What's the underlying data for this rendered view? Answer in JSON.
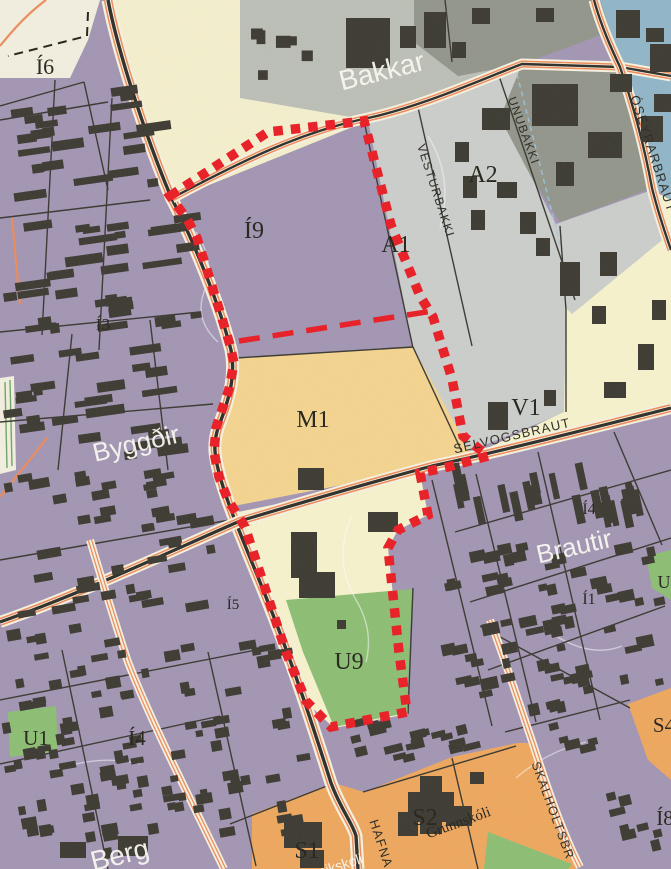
{
  "map": {
    "canvas": {
      "w": 671,
      "h": 869
    },
    "palette": {
      "base_purple": "#a295b3",
      "building": "#3a382f",
      "cream": "#f5f0cd",
      "cream_light": "#f3efe0",
      "gray_bakkar": "#bcbfb6",
      "olive": "#92958a",
      "gray_a": "#cbcecb",
      "blue": "#90b6c8",
      "yellow_pale": "#f7f3cd",
      "tan_m1": "#f5d48e",
      "green": "#8cbe72",
      "orange_s": "#efa75c",
      "road_orange": "#ef8a58",
      "road_cream": "#f7f2e0",
      "road_black": "#2d2c26",
      "boundary_red": "#ea1b22",
      "contour_white": "#ffffff",
      "utility_blue": "#9cc8e2",
      "green_line": "#5e9c57"
    },
    "zones": [
      {
        "name": "cream-top-left",
        "fill": "cream_light",
        "points": "0,0 100,0 88,40 70,78 0,78"
      },
      {
        "name": "cream-road-strip",
        "fill": "cream",
        "points": "108,0 240,0 240,96 370,120 172,200 120,40"
      },
      {
        "name": "bakkar-gray",
        "fill": "gray_bakkar",
        "points": "240,0 414,0 414,42 458,76 522,64 368,120 240,98"
      },
      {
        "name": "olive-north",
        "fill": "olive",
        "points": "414,0 598,0 620,28 522,64 458,76 414,42"
      },
      {
        "name": "olive-east",
        "fill": "olive",
        "points": "522,64 620,68 652,188 560,222 496,120"
      },
      {
        "name": "gray-a1-a2",
        "fill": "gray_a",
        "points": "368,120 522,64 500,118 556,224 566,310 566,412 460,455 413,348"
      },
      {
        "name": "gray-a-east",
        "fill": "gray_a",
        "points": "556,224 652,190 662,240 572,314 566,310"
      },
      {
        "name": "blue-northeast",
        "fill": "blue",
        "points": "600,0 671,0 671,200 652,186 622,66"
      },
      {
        "name": "yellow-v1",
        "fill": "yellow_pale",
        "points": "652,190 671,200 671,410 462,460 564,412 566,308 572,314 662,240"
      },
      {
        "name": "tan-m1",
        "fill": "tan_m1",
        "points": "236,358 413,347 470,452 460,462 234,506 216,472 216,424 230,388"
      },
      {
        "name": "yellow-below-road",
        "fill": "yellow_pale",
        "points": "238,512 452,468 488,456 448,467 420,473 428,515 398,530 388,548 399,652 408,714 334,728 306,702 286,652 263,582 245,527"
      },
      {
        "name": "green-u9",
        "fill": "green",
        "points": "286,600 412,589 407,713 334,727 303,652"
      },
      {
        "name": "green-u1",
        "fill": "green",
        "points": "8,712 56,706 58,752 10,757"
      },
      {
        "name": "green-east-patch",
        "fill": "green",
        "points": "646,556 671,550 671,600 652,588"
      },
      {
        "name": "orange-s1-s2",
        "fill": "orange_s",
        "points": "252,814 334,783 364,792 452,757 517,743 531,743 560,835 576,860 576,869 252,869"
      },
      {
        "name": "orange-s4",
        "fill": "orange_s",
        "points": "628,704 671,688 671,780 648,760"
      },
      {
        "name": "green-southeast",
        "fill": "green",
        "points": "488,832 572,864 568,869 484,869"
      },
      {
        "name": "cream-west-strip",
        "fill": "cream_light",
        "points": "0,378 14,376 16,470 0,474"
      }
    ],
    "contours": [
      {
        "d": "M196,232 q20,30 8,60 q-10,28 14,50",
        "s": "contour_white",
        "o": 0.5
      },
      {
        "d": "M352,516 q-20,42 4,84 q18,30 10,62",
        "s": "contour_white",
        "o": 0.5
      },
      {
        "d": "M428,136 q26,42 12,92",
        "s": "contour_white",
        "o": 0.45
      },
      {
        "d": "M517,74 L562,252",
        "s": "utility_blue",
        "o": 0.85,
        "dash": "5 4"
      },
      {
        "d": "M556,636 q36,22 66,10",
        "s": "contour_white",
        "o": 0.5
      },
      {
        "d": "M56,770 q44,-16 84,-6",
        "s": "contour_white",
        "o": 0.5
      },
      {
        "d": "M586,742 q-40,10 -70,36",
        "s": "contour_white",
        "o": 0.5
      },
      {
        "d": "M5,382 L7,468",
        "s": "green_line",
        "o": 0.9
      },
      {
        "d": "M10,380 L12,466",
        "s": "green_line",
        "o": 0.9
      }
    ],
    "streets": [
      [
        55,
        80,
        42,
        335
      ],
      [
        112,
        98,
        99,
        350
      ],
      [
        0,
        120,
        108,
        102
      ],
      [
        0,
        218,
        150,
        200
      ],
      [
        0,
        332,
        200,
        312
      ],
      [
        0,
        422,
        213,
        404
      ],
      [
        72,
        334,
        58,
        470
      ],
      [
        150,
        320,
        168,
        470
      ],
      [
        84,
        82,
        108,
        190
      ],
      [
        0,
        106,
        84,
        82
      ],
      [
        0,
        700,
        256,
        650
      ],
      [
        62,
        650,
        108,
        869
      ],
      [
        208,
        652,
        256,
        866
      ],
      [
        0,
        764,
        220,
        716
      ],
      [
        0,
        560,
        230,
        520
      ],
      [
        455,
        532,
        671,
        470
      ],
      [
        470,
        602,
        671,
        538
      ],
      [
        488,
        670,
        665,
        606
      ],
      [
        432,
        480,
        492,
        726
      ],
      [
        538,
        452,
        600,
        720
      ],
      [
        614,
        432,
        662,
        545
      ],
      [
        476,
        474,
        536,
        722
      ],
      [
        417,
        103,
        472,
        346
      ],
      [
        497,
        70,
        575,
        300
      ],
      [
        445,
        0,
        452,
        62
      ],
      [
        480,
        626,
        630,
        708
      ],
      [
        363,
        792,
        516,
        746
      ],
      [
        230,
        824,
        332,
        784
      ],
      [
        452,
        758,
        478,
        869
      ],
      [
        236,
        358,
        413,
        347
      ],
      [
        364,
        121,
        413,
        348
      ],
      [
        413,
        347,
        462,
        452
      ],
      [
        560,
        226,
        566,
        310
      ],
      [
        566,
        310,
        566,
        412
      ],
      [
        413,
        588,
        408,
        714
      ],
      [
        505,
        732,
        630,
        700
      ]
    ],
    "roads": [
      {
        "name": "main-road",
        "style": "major",
        "d": "M108,0 C120,62 152,152 171,197 C186,226 216,292 231,350 C236,376 229,400 218,428 C213,444 214,456 221,480 C233,522 262,582 287,652 C301,690 318,742 331,783 C341,810 352,822 356,836 L358,869"
      },
      {
        "name": "top-road",
        "style": "secondary",
        "d": "M172,198 C240,162 300,132 368,118 C420,107 480,80 522,64 L620,67 L671,76"
      },
      {
        "name": "oseyrarbraut-road",
        "style": "secondary",
        "d": "M594,0 C601,26 612,50 620,67 C635,110 645,150 652,188 C658,212 664,230 671,250"
      },
      {
        "name": "selvogsbraut-road",
        "style": "major2",
        "d": "M0,622 C80,594 160,556 240,521 C310,500 372,482 432,466 C502,451 580,431 671,408"
      },
      {
        "name": "skalholtsbraut-road",
        "style": "minor",
        "d": "M490,620 C505,660 520,706 533,744 C546,784 562,832 580,867"
      },
      {
        "name": "west-orange-road",
        "style": "minor",
        "d": "M90,540 C102,580 114,620 128,662 C152,724 192,802 224,869"
      },
      {
        "name": "top-left-arc-road",
        "style": "thin",
        "d": "M0,46 Q24,16 46,0"
      },
      {
        "name": "left-orange-stub",
        "style": "thin",
        "d": "M12,218 L20,304"
      },
      {
        "name": "sw-orange-stub",
        "style": "thin",
        "d": "M47,438 L0,497"
      }
    ],
    "buildings": [
      [
        346,
        18,
        44,
        50
      ],
      [
        400,
        26,
        16,
        22
      ],
      [
        424,
        12,
        22,
        36
      ],
      [
        452,
        42,
        14,
        16
      ],
      [
        472,
        8,
        18,
        16
      ],
      [
        536,
        8,
        18,
        14
      ],
      [
        532,
        84,
        46,
        42
      ],
      [
        588,
        132,
        34,
        26
      ],
      [
        610,
        74,
        22,
        18
      ],
      [
        556,
        162,
        18,
        24
      ],
      [
        482,
        108,
        28,
        22
      ],
      [
        455,
        142,
        14,
        20
      ],
      [
        463,
        176,
        14,
        22
      ],
      [
        471,
        210,
        14,
        20
      ],
      [
        497,
        182,
        20,
        16
      ],
      [
        520,
        212,
        16,
        22
      ],
      [
        536,
        238,
        14,
        18
      ],
      [
        616,
        10,
        24,
        28
      ],
      [
        646,
        28,
        18,
        14
      ],
      [
        650,
        44,
        21,
        28
      ],
      [
        654,
        94,
        17,
        18
      ],
      [
        641,
        116,
        22,
        26
      ],
      [
        560,
        262,
        20,
        34
      ],
      [
        600,
        252,
        17,
        24
      ],
      [
        592,
        306,
        14,
        18
      ],
      [
        638,
        344,
        16,
        26
      ],
      [
        604,
        382,
        22,
        16
      ],
      [
        488,
        402,
        20,
        28
      ],
      [
        544,
        390,
        12,
        16
      ],
      [
        652,
        300,
        14,
        20
      ],
      [
        298,
        468,
        26,
        22
      ],
      [
        291,
        532,
        26,
        46
      ],
      [
        299,
        572,
        36,
        26
      ],
      [
        368,
        512,
        30,
        20
      ],
      [
        337,
        620,
        9,
        9
      ],
      [
        408,
        792,
        46,
        30
      ],
      [
        420,
        776,
        22,
        58
      ],
      [
        398,
        812,
        20,
        24
      ],
      [
        446,
        806,
        26,
        20
      ],
      [
        470,
        772,
        14,
        12
      ],
      [
        284,
        822,
        38,
        26
      ],
      [
        300,
        850,
        24,
        18
      ],
      [
        118,
        836,
        30,
        20
      ],
      [
        60,
        842,
        26,
        16
      ]
    ],
    "clusters": [
      {
        "x": 2,
        "y": 86,
        "w": 200,
        "h": 375,
        "n": 80,
        "wMin": 9,
        "wMax": 40,
        "hMin": 6,
        "hMax": 10,
        "angle": -8,
        "seed": 11
      },
      {
        "x": 2,
        "y": 622,
        "w": 315,
        "h": 240,
        "n": 105,
        "wMin": 7,
        "wMax": 17,
        "hMin": 6,
        "hMax": 12,
        "angle": -10,
        "seed": 22
      },
      {
        "x": 442,
        "y": 462,
        "w": 226,
        "h": 66,
        "n": 24,
        "wMin": 6,
        "wMax": 9,
        "hMin": 20,
        "hMax": 30,
        "angle": -12,
        "seed": 33
      },
      {
        "x": 438,
        "y": 542,
        "w": 230,
        "h": 175,
        "n": 66,
        "wMin": 7,
        "wMax": 18,
        "hMin": 6,
        "hMax": 12,
        "angle": -12,
        "seed": 44
      },
      {
        "x": 342,
        "y": 716,
        "w": 165,
        "h": 46,
        "n": 20,
        "wMin": 8,
        "wMax": 20,
        "hMin": 6,
        "hMax": 10,
        "angle": -14,
        "seed": 55
      },
      {
        "x": 546,
        "y": 700,
        "w": 68,
        "h": 56,
        "n": 7,
        "wMin": 8,
        "wMax": 16,
        "hMin": 6,
        "hMax": 12,
        "angle": -14,
        "seed": 66
      },
      {
        "x": 592,
        "y": 792,
        "w": 76,
        "h": 72,
        "n": 8,
        "wMin": 8,
        "wMax": 16,
        "hMin": 7,
        "hMax": 12,
        "angle": -14,
        "seed": 77
      },
      {
        "x": 250,
        "y": 15,
        "w": 80,
        "h": 68,
        "n": 6,
        "wMin": 8,
        "wMax": 16,
        "hMin": 8,
        "hMax": 14,
        "angle": 0,
        "seed": 88
      },
      {
        "x": 2,
        "y": 468,
        "w": 215,
        "h": 150,
        "n": 42,
        "wMin": 8,
        "wMax": 24,
        "hMin": 6,
        "hMax": 10,
        "angle": -10,
        "seed": 99
      }
    ],
    "boundary": {
      "dotted_points": "170,196 268,132 364,121 391,225 420,296 433,317 452,379 463,436 488,456 448,467 420,473 428,515 398,530 388,548 399,652 407,712 331,727 306,701 286,652 263,582 245,527 228,500 219,477 214,452 216,428 229,389 234,363 230,345 217,302 197,238 187,219",
      "dashed_points": "239,341 433,311",
      "dot_width": 9.5,
      "dot_dash": "9.5 8",
      "dash_width": 5.5,
      "dash_dash": "21 13"
    },
    "black_dash": {
      "d": "M88,12 L87,36 L8,56",
      "dash": "9 6"
    },
    "labels": {
      "zones": [
        {
          "id": "i6",
          "text": "Í6",
          "x": 45,
          "y": 74,
          "size": 22
        },
        {
          "id": "i3",
          "text": "Í3",
          "x": 103,
          "y": 330,
          "size": 17
        },
        {
          "id": "i9",
          "text": "Í9",
          "x": 254,
          "y": 238,
          "size": 24
        },
        {
          "id": "a1",
          "text": "A1",
          "x": 396,
          "y": 252,
          "size": 24
        },
        {
          "id": "a2",
          "text": "A2",
          "x": 483,
          "y": 182,
          "size": 24
        },
        {
          "id": "m1",
          "text": "M1",
          "x": 313,
          "y": 427,
          "size": 24
        },
        {
          "id": "v1",
          "text": "V1",
          "x": 526,
          "y": 415,
          "size": 24
        },
        {
          "id": "i4-east",
          "text": "Í4",
          "x": 589,
          "y": 514,
          "size": 16
        },
        {
          "id": "i1",
          "text": "Í1",
          "x": 589,
          "y": 604,
          "size": 16
        },
        {
          "id": "u-east",
          "text": "U",
          "x": 664,
          "y": 588,
          "size": 18
        },
        {
          "id": "i5",
          "text": "Í5",
          "x": 233,
          "y": 609,
          "size": 15
        },
        {
          "id": "u9",
          "text": "U9",
          "x": 349,
          "y": 669,
          "size": 24
        },
        {
          "id": "u1",
          "text": "U1",
          "x": 36,
          "y": 745,
          "size": 21
        },
        {
          "id": "i4-west",
          "text": "Í4",
          "x": 137,
          "y": 745,
          "size": 21
        },
        {
          "id": "s1",
          "text": "S1",
          "x": 307,
          "y": 858,
          "size": 24
        },
        {
          "id": "s2",
          "text": "S2",
          "x": 425,
          "y": 825,
          "size": 24
        },
        {
          "id": "s4",
          "text": "S4",
          "x": 664,
          "y": 732,
          "size": 21
        },
        {
          "id": "i8",
          "text": "Í8",
          "x": 665,
          "y": 825,
          "size": 21
        },
        {
          "id": "grunnskoli",
          "text": "Grunnskóli",
          "x": 460,
          "y": 827,
          "size": 15,
          "rotate": -20
        }
      ],
      "neighborhoods": [
        {
          "id": "bakkar",
          "text": "Bakkar",
          "x": 384,
          "y": 80,
          "size": 28,
          "rotate": -14
        },
        {
          "id": "byggdir",
          "text": "Byggðir",
          "x": 138,
          "y": 452,
          "size": 26,
          "rotate": -13
        },
        {
          "id": "brautir",
          "text": "Brautir",
          "x": 576,
          "y": 555,
          "size": 26,
          "rotate": -13
        },
        {
          "id": "berg",
          "text": "Berg",
          "x": 122,
          "y": 864,
          "size": 28,
          "rotate": -14
        },
        {
          "id": "leikskoli",
          "text": "Leikskóli",
          "x": 338,
          "y": 871,
          "size": 14,
          "rotate": -18
        }
      ],
      "streets": [
        {
          "id": "vesturbakki",
          "text": "VESTURBAKKI",
          "x": 432,
          "y": 192,
          "size": 12,
          "rotate": 72
        },
        {
          "id": "unubakki",
          "text": "UNUBAKKI",
          "x": 520,
          "y": 132,
          "size": 12,
          "rotate": 70
        },
        {
          "id": "oseyrarbraut",
          "text": "ÓSEYRARBRAUT",
          "x": 649,
          "y": 155,
          "size": 13,
          "rotate": 72
        },
        {
          "id": "selvogsbraut",
          "text": "SELVOGSBRAUT",
          "x": 513,
          "y": 440,
          "size": 13,
          "rotate": -13
        },
        {
          "id": "skalholtsbraut",
          "text": "SKALHOLTSBR",
          "x": 549,
          "y": 812,
          "size": 12.5,
          "rotate": 70
        },
        {
          "id": "hafnarvegur",
          "text": "HAFNA",
          "x": 377,
          "y": 845,
          "size": 13,
          "rotate": 72
        }
      ]
    }
  }
}
